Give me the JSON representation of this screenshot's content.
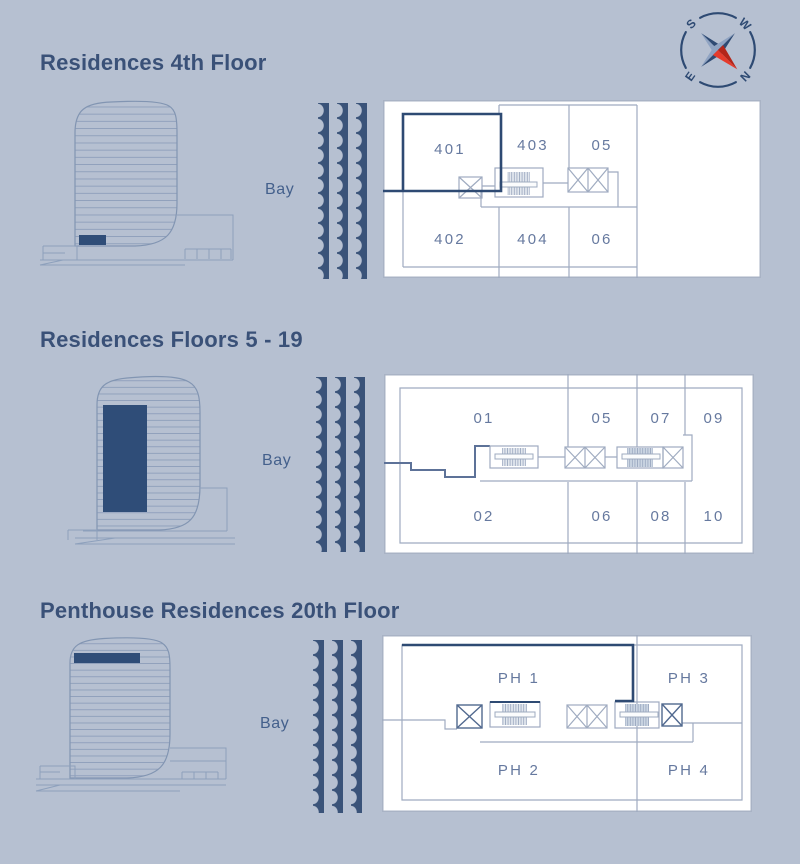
{
  "palette": {
    "background": "#b6c0d1",
    "title_text": "#3a5178",
    "unit_label": "#66799f",
    "plan_line_light": "#9fabc0",
    "plan_line_dark": "#2e4a73",
    "wave": "#3a5379",
    "panel_white": "#ffffff",
    "building_line": "#8295b2",
    "building_highlight": "#2f4d78",
    "compass_red": "#e53b2c"
  },
  "compass": {
    "n": "N",
    "s": "S",
    "e": "E",
    "w": "W"
  },
  "sections": [
    {
      "title": "Residences 4th Floor",
      "bay_label": "Bay",
      "units_top": [
        "401",
        "403",
        "05"
      ],
      "units_bottom": [
        "402",
        "404",
        "06"
      ],
      "highlighted_unit": "401"
    },
    {
      "title": "Residences Floors 5 - 19",
      "bay_label": "Bay",
      "units_top": [
        "01",
        "05",
        "07",
        "09"
      ],
      "units_bottom": [
        "02",
        "06",
        "08",
        "10"
      ],
      "highlighted_unit": ""
    },
    {
      "title": "Penthouse Residences 20th Floor",
      "bay_label": "Bay",
      "units_top": [
        "PH 1",
        "PH 3"
      ],
      "units_bottom": [
        "PH 2",
        "PH 4"
      ],
      "highlighted_unit": "PH 1"
    }
  ]
}
